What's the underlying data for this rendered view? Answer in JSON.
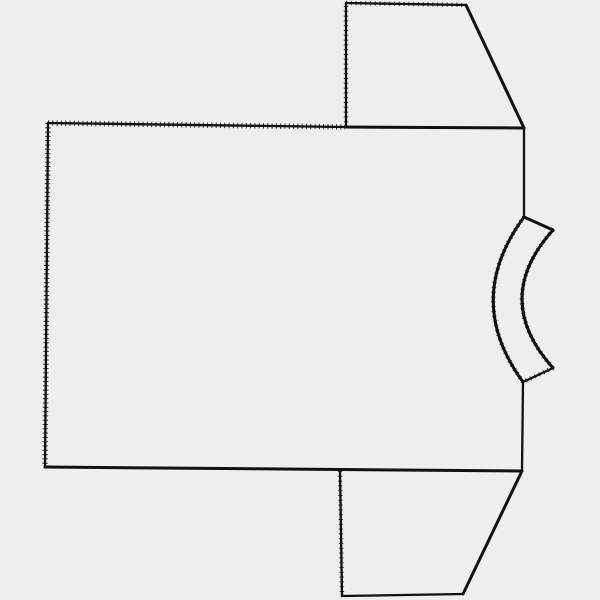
{
  "drawing": {
    "description": "Hand-drawn sewing-pattern style outline of a short-sleeved t-shirt, rotated 90 degrees so the curved neckline band faces right; sleeves point up-right and down-right; serrated (pinked) texture on the left/top fold edges and around the neck band",
    "background_color": "#eeeeee",
    "ink_color": "#111111",
    "canvas": {
      "width": "600",
      "height": "600",
      "viewbox": "0 0 600 600"
    },
    "paths": {
      "body_top_serrated": "M48 123 L345 127",
      "body_top_solid": "M345 127 L524 128",
      "body_left": "M48 123 L45 467",
      "body_bottom": "M45 467 L522 471",
      "body_right_upper": "M524 128 L524 217",
      "body_right_lower": "M523 382 L522 471",
      "sleeve_top_left": "M346 127 L346 3",
      "sleeve_top_top": "M346 3 L466 5",
      "sleeve_top_slant": "M466 5 L524 128",
      "sleeve_bottom_left": "M340 471 L342 596",
      "sleeve_bottom_bottom": "M342 596 L463 594",
      "sleeve_bottom_slant": "M463 594 L521 473",
      "neckband_top_connector": "M524 217 L553 230",
      "neckband_inner_arc": "M553 230 Q491 299 553 368",
      "neckband_bottom_connector": "M553 368 L523 382",
      "neckband_outer_arc": "M523 382 Q463 300 524 217"
    }
  }
}
